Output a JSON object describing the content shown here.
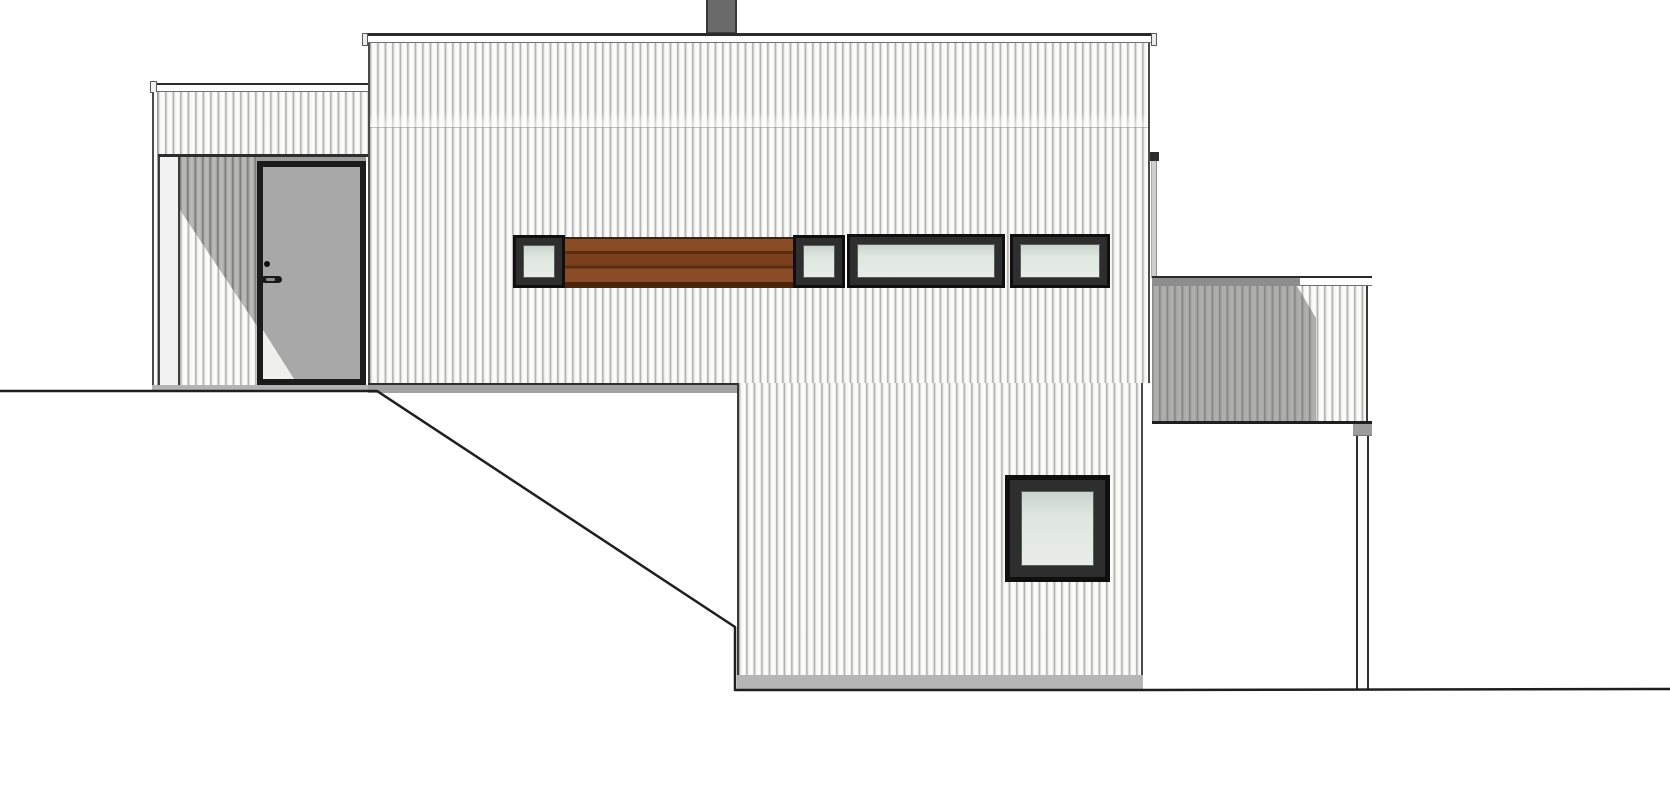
{
  "meta": {
    "type": "architectural elevation drawing",
    "view": "house side elevation with sloping terrain",
    "canvas_width_px": 1670,
    "canvas_height_px": 800,
    "background": "#ffffff",
    "visible_text": "none"
  },
  "palette": {
    "outline_dark": "#1f1f1f",
    "cladding_base": "#fbfbfa",
    "cladding_stripe": "#9f9f9e",
    "cladding_shadowed": "#a3a3a3",
    "fascia_white": "#fdfdfd",
    "soffit_gray": "#a2a2a2",
    "foundation_gray": "#b5b5b5",
    "chimney_gray": "#6a6a6a",
    "door_leaf_gray": "#a8a8a8",
    "window_frame_dark": "#0f0f0f",
    "glass_green_gray": "#dfe7e0",
    "wood_panel_brown": "#8a4c27",
    "wood_panel_line": "#5a2c10",
    "annex_shadow_overlay": "rgba(80,80,80,0.45)"
  },
  "scene": {
    "chimney": {
      "x": 706,
      "y": 0,
      "w": 31,
      "h": 34,
      "color": "#6a6a6a"
    },
    "main_house": {
      "roof_fascia": {
        "x": 362,
        "y": 33,
        "w": 795,
        "h": 10
      },
      "upper_wall": {
        "x": 368,
        "y": 43,
        "w": 782,
        "h": 340,
        "cladding": "vertical boards"
      },
      "facade_seam_y": 127,
      "cantilever_soffit": {
        "x": 368,
        "y": 383,
        "w": 369,
        "h": 10
      },
      "lower_wall": {
        "x": 737,
        "y": 383,
        "w": 406,
        "h": 292,
        "cladding": "vertical boards"
      },
      "foundation_band": {
        "x": 737,
        "y": 675,
        "w": 406,
        "h": 15
      }
    },
    "entry_wing": {
      "fascia": {
        "x": 150,
        "y": 83,
        "w": 218,
        "h": 9
      },
      "siding_band": {
        "x": 158,
        "y": 92,
        "w": 210,
        "h": 62
      },
      "corner_trim": {
        "x": 152,
        "y": 92,
        "w": 6,
        "h": 300
      },
      "recess": {
        "x": 158,
        "y": 157,
        "w": 208,
        "h": 228,
        "corner_post": {
          "x": 158,
          "w": 22
        },
        "sunlight_triangle": "lower-left diagonal light patch",
        "door": {
          "x": 257,
          "y": 161,
          "w": 109,
          "h": 224,
          "leaf_color": "#a8a8a8",
          "frame_color": "#1c1c1c",
          "hardware": "black knob dot and lever handle"
        }
      },
      "base_band": {
        "x": 152,
        "y": 385,
        "w": 216,
        "h": 7
      }
    },
    "window_band": {
      "y": 234,
      "h": 54,
      "windows": [
        {
          "id": "small-square-left",
          "x": 513,
          "y": 235,
          "w": 52,
          "h": 53
        },
        {
          "id": "small-square-mid",
          "x": 793,
          "y": 235,
          "w": 52,
          "h": 53
        },
        {
          "id": "wide-strip",
          "x": 847,
          "y": 234,
          "w": 158,
          "h": 54
        },
        {
          "id": "medium-strip",
          "x": 1010,
          "y": 234,
          "w": 100,
          "h": 54
        }
      ],
      "wood_panel": {
        "x": 565,
        "y": 237,
        "w": 228,
        "h": 51,
        "slats": 3,
        "color": "#8a4c27"
      }
    },
    "lower_window": {
      "x": 1005,
      "y": 475,
      "w": 105,
      "h": 107
    },
    "downspout": {
      "x": 1151,
      "y": 156,
      "w": 6,
      "h": 122
    },
    "annex": {
      "fascia": {
        "x": 1152,
        "y": 276,
        "w": 220,
        "h": 10
      },
      "wall": {
        "x": 1152,
        "y": 286,
        "w": 216,
        "h": 135,
        "cladding": "vertical boards"
      },
      "cast_shadow": {
        "from": "main house",
        "covers_x": [
          1152,
          1316
        ],
        "diagonal_corner": [
          [
            1297,
            286
          ],
          [
            1316,
            318
          ]
        ]
      },
      "bottom_edge_y": 421
    },
    "post": {
      "x": 1356,
      "y": 424,
      "w": 13,
      "h": 266,
      "cap": "gray block at top"
    },
    "ground": {
      "left_level": {
        "from_x": 0,
        "to_x": 377,
        "y": 391
      },
      "slope": {
        "from": [
          377,
          391
        ],
        "to": [
          735,
          627
        ]
      },
      "basement_wall_edge": {
        "x": 735,
        "from_y": 627,
        "to_y": 690
      },
      "base_line": {
        "from_x": 735,
        "to_x": 1143,
        "y": 690
      },
      "right_level": {
        "from_x": 1143,
        "to_x": 1670,
        "y": 689
      }
    }
  }
}
